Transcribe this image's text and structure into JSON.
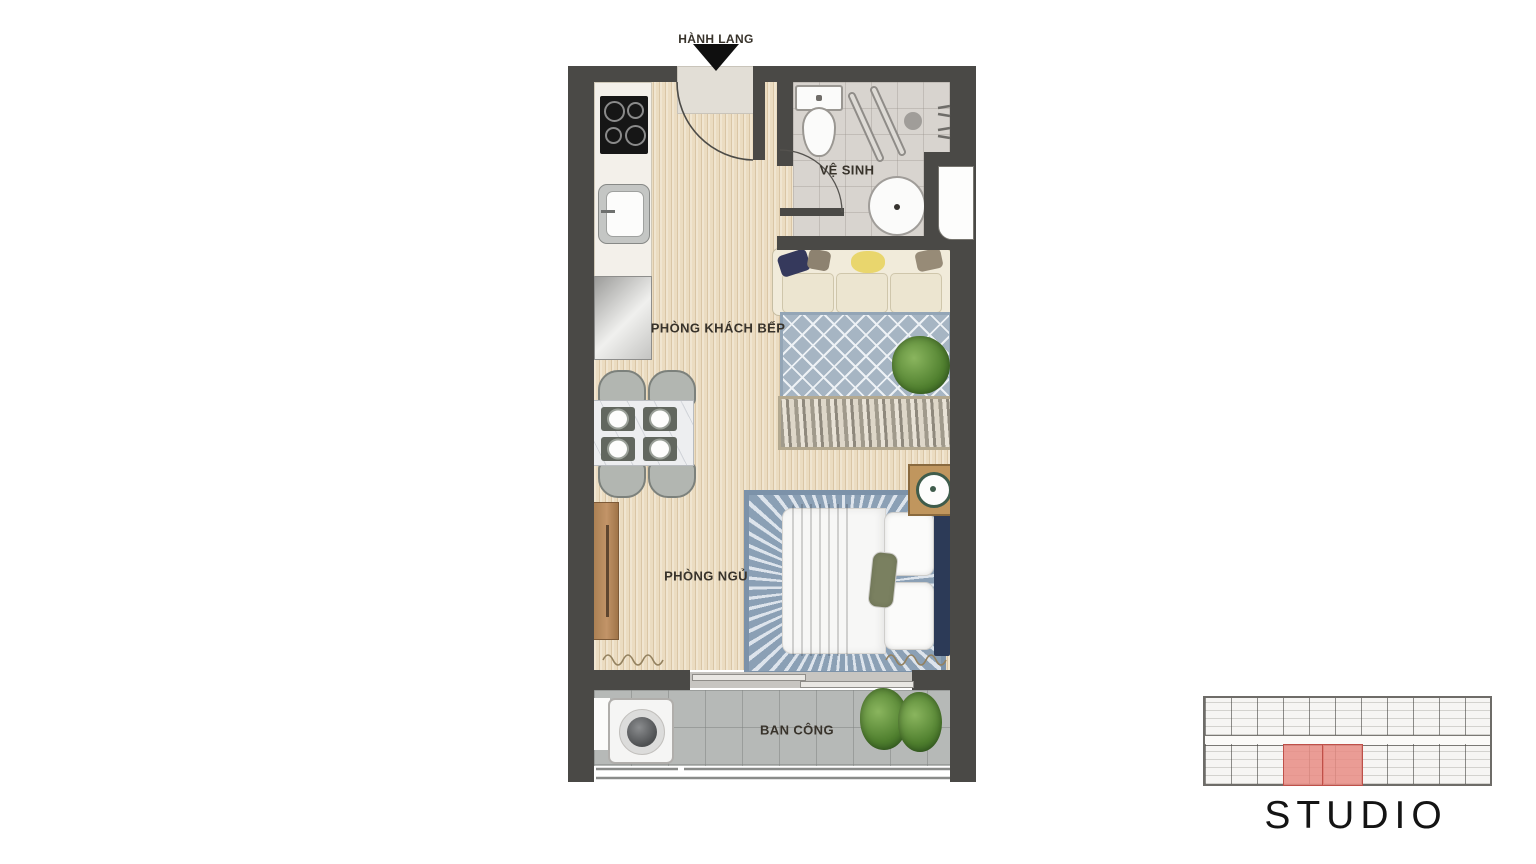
{
  "floorplan": {
    "labels": {
      "corridor": "HÀNH LANG",
      "bathroom": "VỆ SINH",
      "living_kitchen": "PHÒNG KHÁCH BẾP",
      "bedroom": "PHÒNG NGỦ",
      "balcony": "BAN CÔNG"
    },
    "colors": {
      "wall": "#4a4946",
      "wood_floor": "#ebdcc1",
      "bathroom_floor": "#d8d4cf",
      "balcony_floor": "#b6b9b7",
      "living_rug": "#a6b5c3",
      "bedroom_rug": "#8ba0b5",
      "sofa": "#f1ebda",
      "bed_blanket": "#6c7356",
      "bed_headboard": "#2c3a57",
      "wood_furniture": "#b5885e",
      "unit_highlight": "#e8968e"
    }
  },
  "keyplan": {
    "unit_type_label": "STUDIO",
    "highlighted_units": 2
  }
}
